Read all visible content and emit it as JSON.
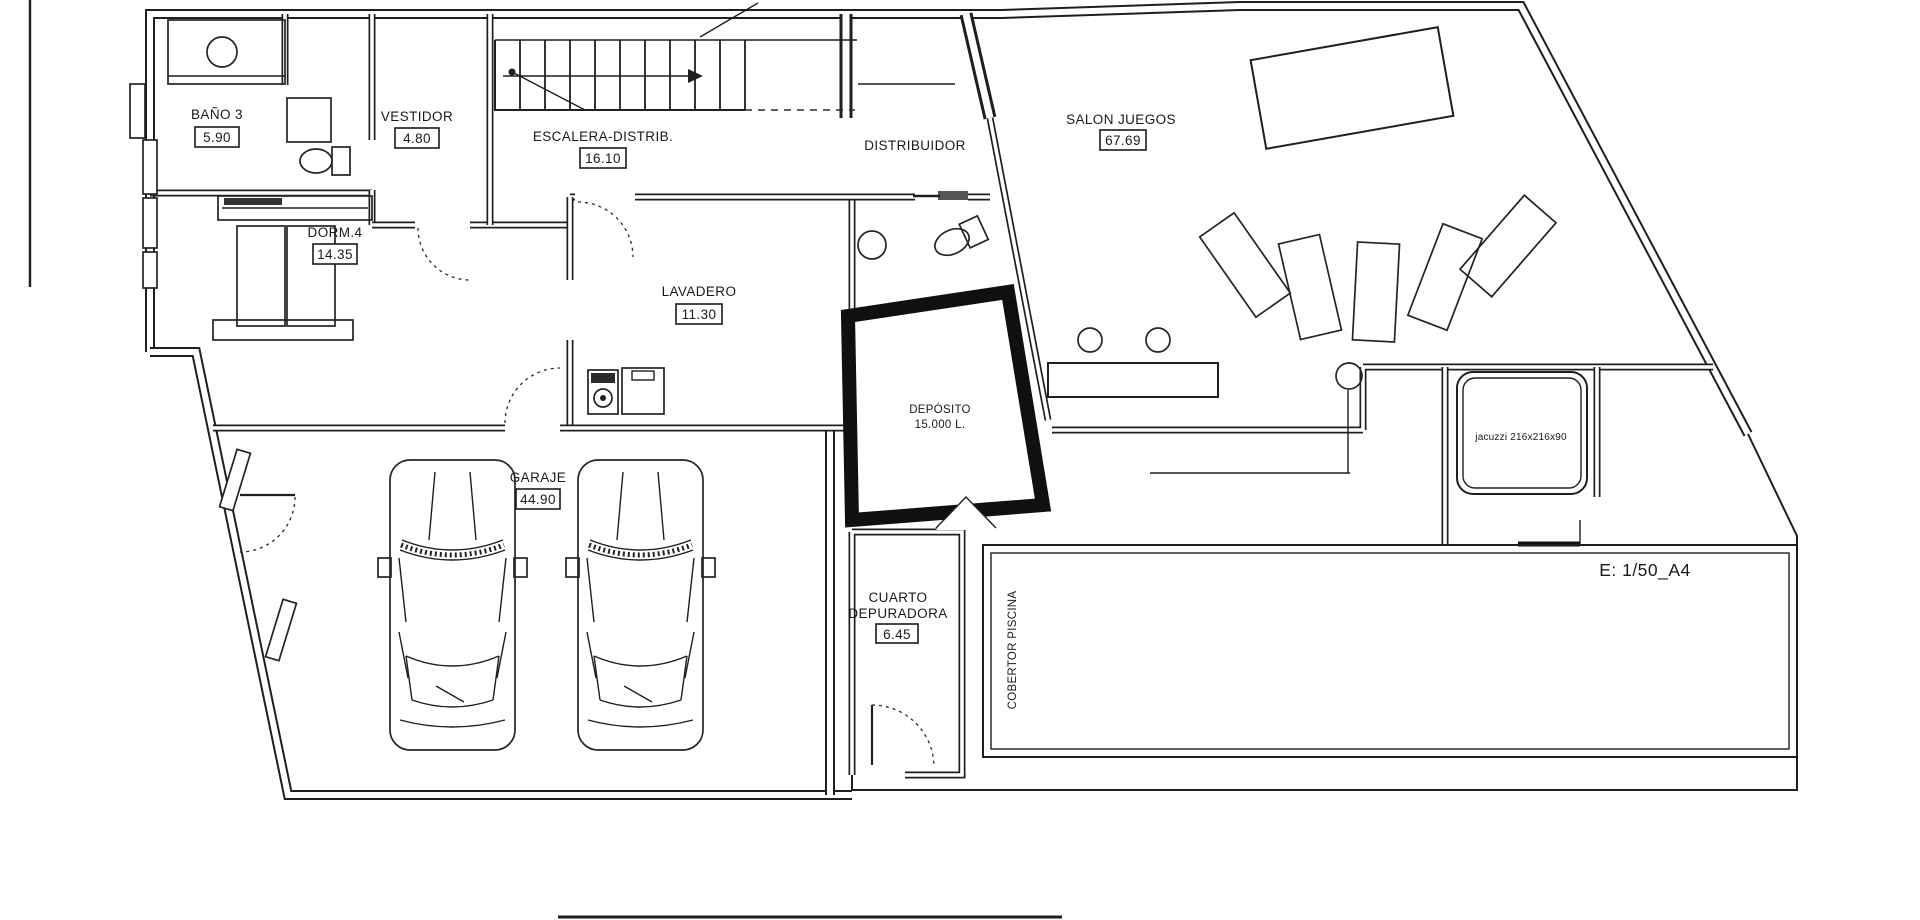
{
  "rooms": [
    {
      "name": "BAÑO 3",
      "area": "5.90"
    },
    {
      "name": "VESTIDOR",
      "area": "4.80"
    },
    {
      "name": "ESCALERA-DISTRIB.",
      "area": "16.10"
    },
    {
      "name": "DORM.4",
      "area": "14.35"
    },
    {
      "name": "LAVADERO",
      "area": "11.30"
    },
    {
      "name": "SALON JUEGOS",
      "area": "67.69"
    },
    {
      "name": "GARAJE",
      "area": "44.90"
    },
    {
      "name_line1": "CUARTO",
      "name_line2": "DEPURADORA",
      "area": "6.45"
    }
  ],
  "labels": {
    "distribuidor": "DISTRIBUIDOR",
    "deposito_line1": "DEPÓSITO",
    "deposito_line2": "15.000 L.",
    "cobertor_piscina": "COBERTOR PISCINA",
    "jacuzzi": "jacuzzi 216x216x90",
    "scale_note": "E: 1/50_A4"
  },
  "colors": {
    "line": "#1f1f1f",
    "background": "#ffffff",
    "tank_wall": "#101010"
  }
}
